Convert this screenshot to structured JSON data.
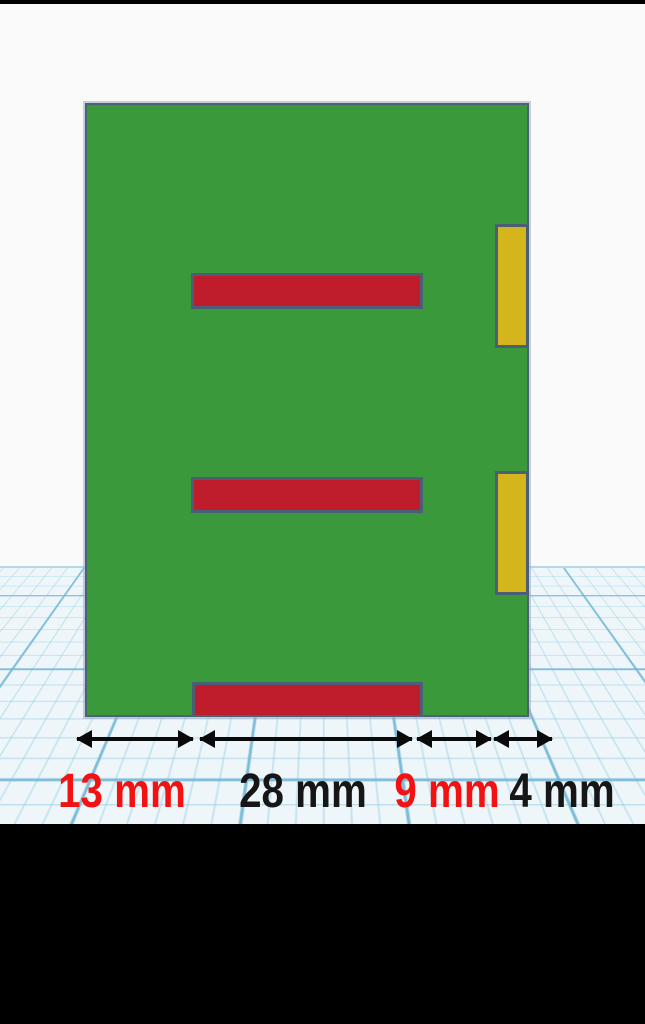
{
  "viewport": {
    "background": "#fafafa",
    "workplane_color": "#eef6fa",
    "grid_line_color": "#a9d2e4",
    "horizon_color": "#b3d9e8",
    "letterbox_color": "#000000"
  },
  "model": {
    "board": {
      "name": "green-board",
      "fill": "#3a9a3b",
      "outline": "#4c6177"
    },
    "slots": [
      {
        "name": "red-slot-top",
        "fill": "#bf1d2b"
      },
      {
        "name": "red-slot-middle",
        "fill": "#bf1d2b"
      },
      {
        "name": "red-slot-bottom",
        "fill": "#bf1d2b"
      }
    ],
    "tabs": [
      {
        "name": "yellow-tab-top",
        "fill": "#d4b61c"
      },
      {
        "name": "yellow-tab-bottom",
        "fill": "#d4b61c"
      }
    ]
  },
  "annotations": {
    "arrow_color": "#0a0a0a",
    "dimensions": [
      {
        "label": "13 mm",
        "value": 13,
        "unit": "mm",
        "color": "#f31111"
      },
      {
        "label": "28 mm",
        "value": 28,
        "unit": "mm",
        "color": "#161616"
      },
      {
        "label": "9 mm",
        "value": 9,
        "unit": "mm",
        "color": "#f31111"
      },
      {
        "label": "4 mm",
        "value": 4,
        "unit": "mm",
        "color": "#161616"
      }
    ]
  }
}
